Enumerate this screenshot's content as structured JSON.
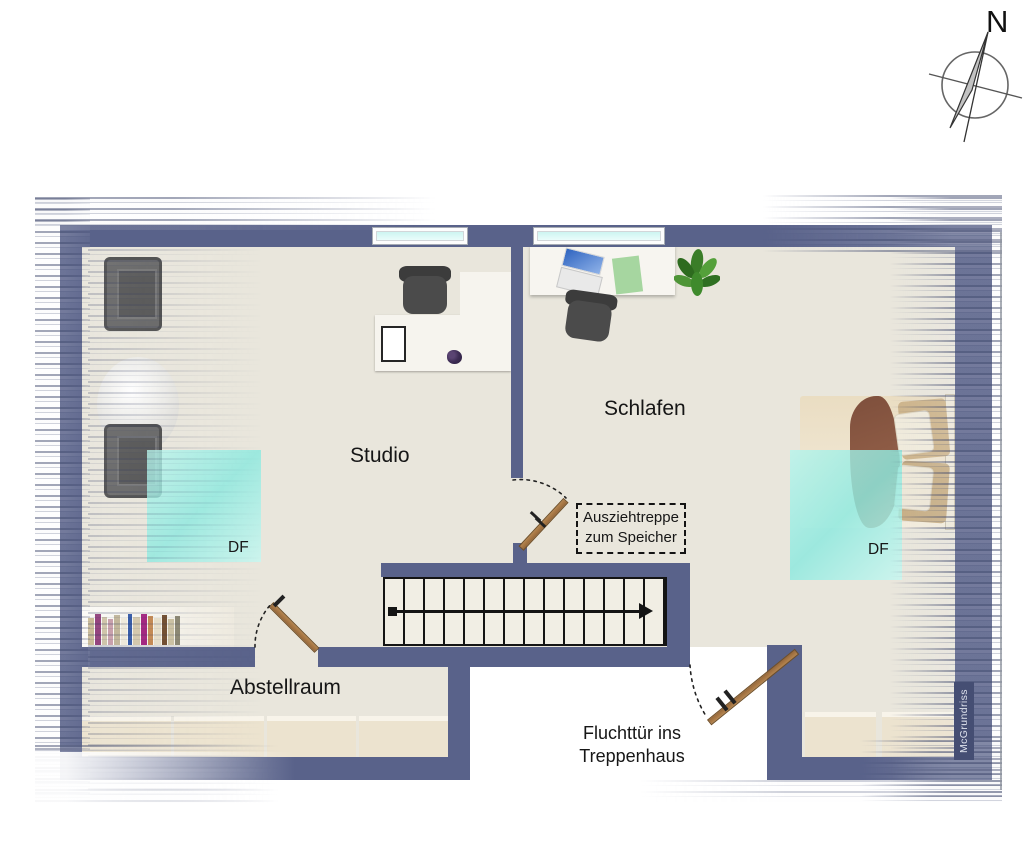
{
  "compass": {
    "north_label": "N"
  },
  "rooms": {
    "studio": "Studio",
    "schlafen": "Schlafen",
    "abstellraum": "Abstellraum"
  },
  "labels": {
    "attic_ladder": [
      "Ausziehtreppe",
      "zum Speicher"
    ],
    "escape_door": [
      "Fluchttür ins",
      "Treppenhaus"
    ],
    "skylight": "DF",
    "watermark": "McGrundriss"
  },
  "stairs": {
    "treads": 14,
    "direction_arrow": "left-to-right"
  },
  "windows": {
    "count": 2
  },
  "skylights": {
    "count": 2
  },
  "doors": [
    "abstellraum-door",
    "attic-ladder-door",
    "escape-door"
  ],
  "furniture": {
    "studio": [
      "armchair",
      "armchair",
      "round-table",
      "l-shaped-desk",
      "office-chair",
      "tablet",
      "bookshelf"
    ],
    "schlafen": [
      "desk",
      "laptop",
      "office-chair",
      "plant",
      "double-bed",
      "dresser",
      "dresser"
    ],
    "abstellraum": [
      "storage-boxes"
    ]
  },
  "colors": {
    "wall": "#59628a",
    "floor": "#e9e6dc",
    "skylight_glass": "#a9ece4",
    "window_glass": "#d8f7f4",
    "door_wood": "#a87947",
    "blanket": "#8a5742"
  }
}
